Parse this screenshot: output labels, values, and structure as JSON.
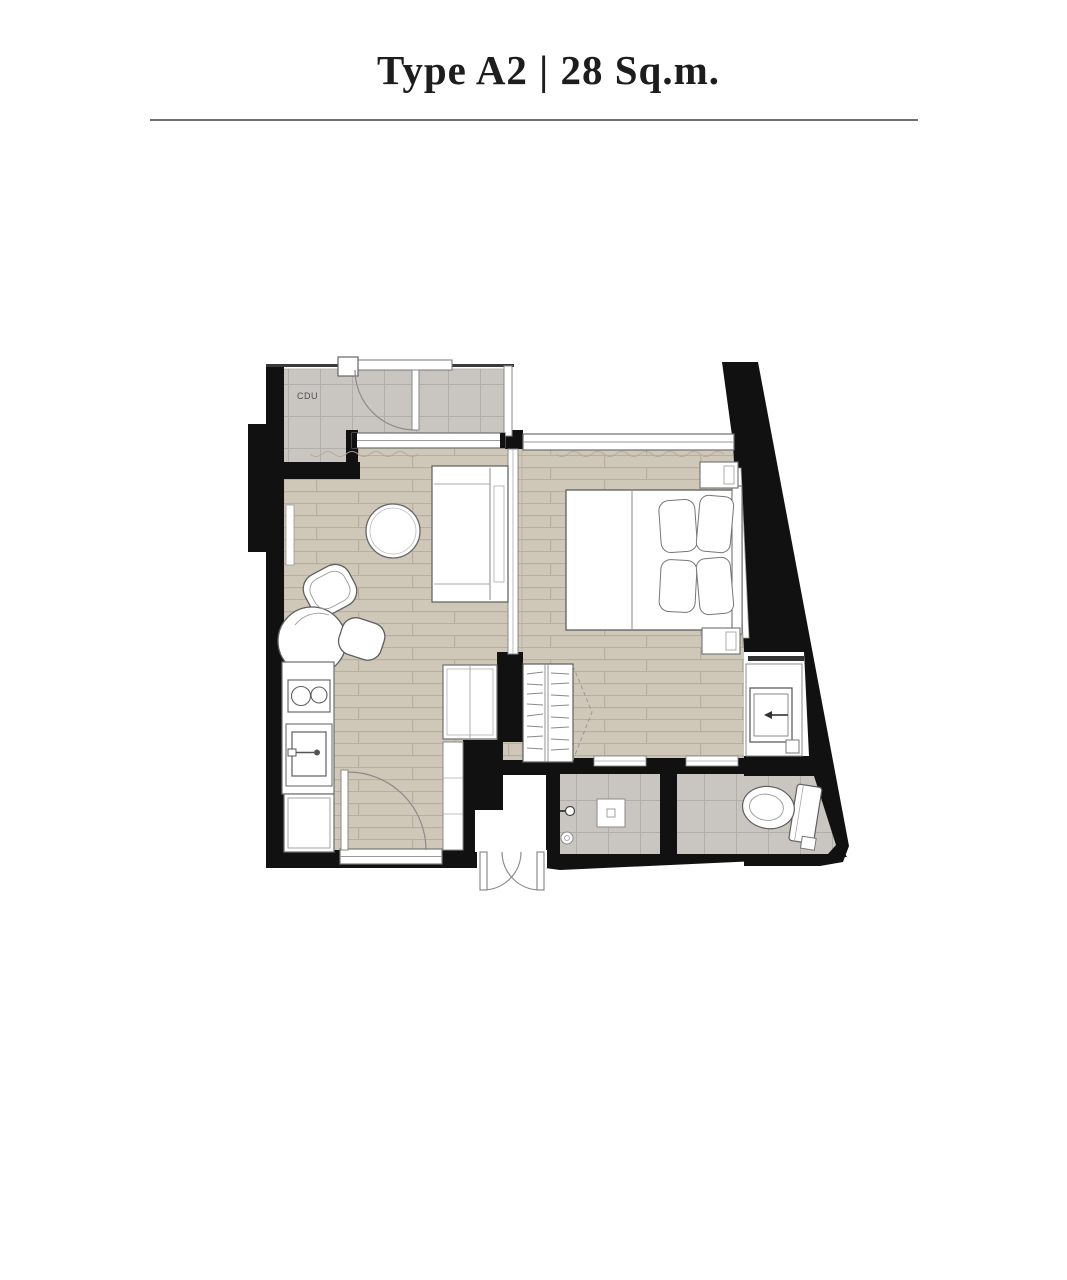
{
  "page": {
    "title": "Type A2 | 28 Sq.m.",
    "unit_type": "Type A2",
    "area": "28 Sq.m."
  },
  "plan": {
    "cdu_label": "CDU"
  },
  "colors": {
    "wall": "#111111",
    "wood_floor": "#cfc7b8",
    "wood_plank_line": "#b7ad9d",
    "tile_floor": "#c9c6c2",
    "tile_grid_line": "#b2afab",
    "furniture_outline": "#6f6f6f",
    "title_text": "#1d1d1d",
    "divider_rule": "#6f6f6f"
  }
}
